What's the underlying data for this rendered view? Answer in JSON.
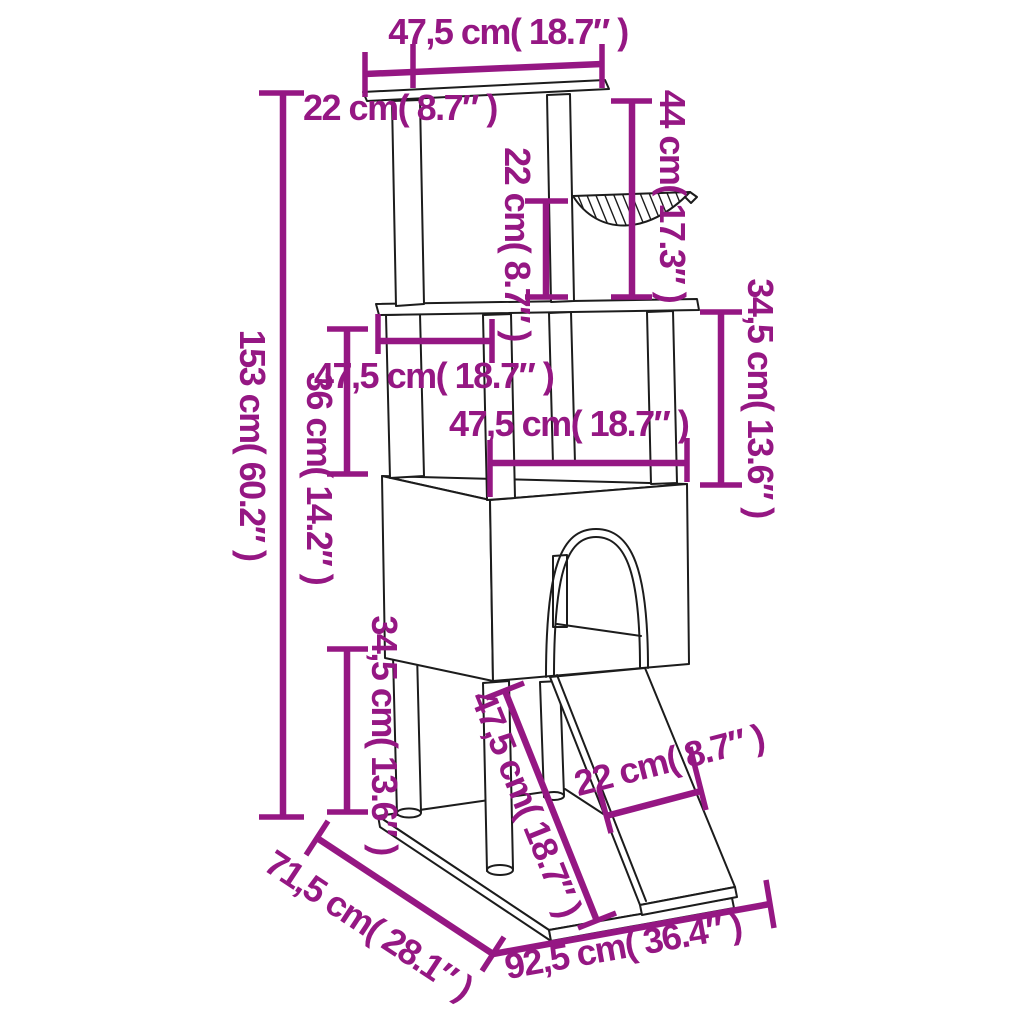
{
  "diagram": {
    "title": "Cat tree with scratching posts – dimension drawing",
    "colors": {
      "dimension_accent": "#951783",
      "outline": "#1c1c1c",
      "background": "#ffffff"
    },
    "labels": {
      "top_width": "47,5 cm( 18.7″ )",
      "top_depth": "22 cm( 8.7″ )",
      "hammock_height": "44 cm( 17.3″ )",
      "hammock_to_platform": "22 cm( 8.7″ )",
      "platform_depth": "47,5 cm( 18.7″ )",
      "right_tier_height": "34,5 cm( 13.6″ )",
      "house_width": "47,5 cm( 18.7″ )",
      "total_height": "153 cm( 60.2″ )",
      "mid_tier_height": "36 cm( 14.2″ )",
      "bottom_tier_height": "34,5 cm( 13.6″ )",
      "ramp_length": "47,5 cm( 18.7″ )",
      "ramp_width": "22 cm( 8.7″ )",
      "base_depth": "71,5 cm( 28.1″ )",
      "base_width": "92,5 cm( 36.4″ )"
    },
    "measurements": [
      {
        "part": "top platform width",
        "cm": "47,5",
        "inch": "18.7"
      },
      {
        "part": "top platform depth",
        "cm": "22",
        "inch": "8.7"
      },
      {
        "part": "top platform to hammock drop",
        "cm": "44",
        "inch": "17.3"
      },
      {
        "part": "hammock to middle platform",
        "cm": "22",
        "inch": "8.7"
      },
      {
        "part": "middle platform depth",
        "cm": "47,5",
        "inch": "18.7"
      },
      {
        "part": "middle platform to house (right)",
        "cm": "34,5",
        "inch": "13.6"
      },
      {
        "part": "house width",
        "cm": "47,5",
        "inch": "18.7"
      },
      {
        "part": "total height",
        "cm": "153",
        "inch": "60.2"
      },
      {
        "part": "platform to house (left)",
        "cm": "36",
        "inch": "14.2"
      },
      {
        "part": "house to base",
        "cm": "34,5",
        "inch": "13.6"
      },
      {
        "part": "ramp length",
        "cm": "47,5",
        "inch": "18.7"
      },
      {
        "part": "ramp width",
        "cm": "22",
        "inch": "8.7"
      },
      {
        "part": "base depth",
        "cm": "71,5",
        "inch": "28.1"
      },
      {
        "part": "base width",
        "cm": "92,5",
        "inch": "36.4"
      }
    ]
  }
}
